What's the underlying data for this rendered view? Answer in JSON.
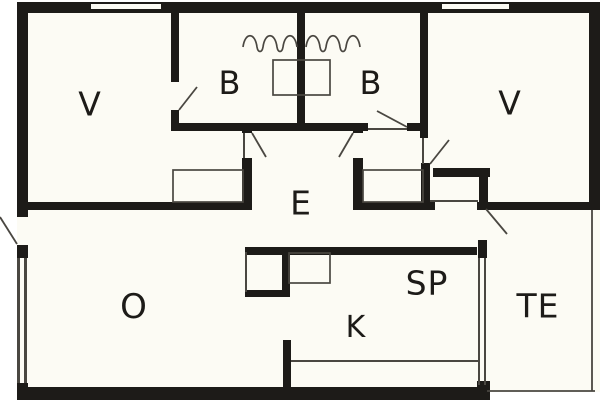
{
  "meta": {
    "title": "House floor plan"
  },
  "colors": {
    "wall": "#1d1b18",
    "floor": "#fcfbf4",
    "thin_line": "#4a4741",
    "label": "#1d1b18",
    "background": "#ffffff"
  },
  "floor": {
    "name": "house-footprint",
    "r": [
      17,
      2,
      583,
      390
    ]
  },
  "rooms": [
    {
      "id": "v1",
      "label": "V",
      "x": 90,
      "y": 104,
      "size": 33
    },
    {
      "id": "b1",
      "label": "B",
      "x": 230,
      "y": 83,
      "size": 32
    },
    {
      "id": "b2",
      "label": "B",
      "x": 371,
      "y": 83,
      "size": 32
    },
    {
      "id": "v2",
      "label": "V",
      "x": 510,
      "y": 103,
      "size": 33
    },
    {
      "id": "e",
      "label": "E",
      "x": 301,
      "y": 203,
      "size": 33
    },
    {
      "id": "o",
      "label": "O",
      "x": 134,
      "y": 307,
      "size": 34
    },
    {
      "id": "sp",
      "label": "SP",
      "x": 427,
      "y": 283,
      "size": 33
    },
    {
      "id": "k",
      "label": "K",
      "x": 356,
      "y": 328,
      "size": 30
    },
    {
      "id": "te",
      "label": "TE",
      "x": 538,
      "y": 306,
      "size": 33
    }
  ],
  "walls": [
    {
      "name": "top-wall",
      "r": [
        17,
        2,
        583,
        11
      ]
    },
    {
      "name": "left-wall-upper",
      "r": [
        17,
        2,
        11,
        215
      ]
    },
    {
      "name": "left-wall-mid-stub",
      "r": [
        17,
        245,
        11,
        13
      ]
    },
    {
      "name": "left-wall-bottom-stub",
      "r": [
        17,
        383,
        11,
        17
      ]
    },
    {
      "name": "bottom-wall",
      "r": [
        17,
        387,
        473,
        13
      ]
    },
    {
      "name": "right-wall",
      "r": [
        589,
        2,
        11,
        208
      ]
    },
    {
      "name": "terrace-top-wall",
      "r": [
        477,
        202,
        123,
        8
      ]
    },
    {
      "name": "v1-b1-wall-upper",
      "r": [
        171,
        13,
        8,
        69
      ]
    },
    {
      "name": "v1-b1-wall-lower",
      "r": [
        171,
        110,
        8,
        21
      ]
    },
    {
      "name": "b1-b2-divider",
      "r": [
        297,
        13,
        8,
        110
      ]
    },
    {
      "name": "b2-v2-wall",
      "r": [
        420,
        13,
        8,
        125
      ]
    },
    {
      "name": "v2-door-side-wall",
      "r": [
        421,
        163,
        9,
        47
      ]
    },
    {
      "name": "hall-north-wall-left",
      "r": [
        171,
        123,
        197,
        8
      ]
    },
    {
      "name": "hall-north-wall-right",
      "r": [
        407,
        123,
        21,
        8
      ]
    },
    {
      "name": "hall-left-wall-stub",
      "r": [
        242,
        123,
        10,
        10
      ]
    },
    {
      "name": "hall-left-wall",
      "r": [
        242,
        158,
        10,
        52
      ]
    },
    {
      "name": "hall-right-wall-stub",
      "r": [
        353,
        123,
        10,
        10
      ]
    },
    {
      "name": "hall-right-wall",
      "r": [
        353,
        158,
        10,
        52
      ]
    },
    {
      "name": "v1-south-wall",
      "r": [
        17,
        202,
        235,
        8
      ]
    },
    {
      "name": "hall-south-wall",
      "r": [
        353,
        202,
        82,
        8
      ]
    },
    {
      "name": "nook-north-wall",
      "r": [
        433,
        168,
        57,
        9
      ]
    },
    {
      "name": "nook-east-wall",
      "r": [
        479,
        177,
        9,
        27
      ]
    },
    {
      "name": "kitchen-north-wall",
      "r": [
        245,
        247,
        232,
        8
      ]
    },
    {
      "name": "kitchen-west-wall",
      "r": [
        283,
        340,
        8,
        47
      ]
    },
    {
      "name": "terrace-door-side-wall",
      "r": [
        478,
        240,
        9,
        18
      ]
    },
    {
      "name": "terrace-window-stub",
      "r": [
        477,
        381,
        13,
        19
      ]
    },
    {
      "name": "cupboard-east-wall",
      "r": [
        282,
        252,
        8,
        45
      ]
    },
    {
      "name": "cupboard-south-wall",
      "r": [
        245,
        290,
        45,
        7
      ]
    }
  ],
  "window_slots": [
    {
      "name": "window-top-left",
      "r": [
        91,
        4,
        70,
        5
      ]
    },
    {
      "name": "window-top-right",
      "r": [
        442,
        4,
        67,
        5
      ]
    }
  ],
  "window_lines": [
    {
      "name": "window-left-outer-line",
      "r": [
        17,
        258,
        3,
        125
      ]
    },
    {
      "name": "window-left-inner-line",
      "r": [
        24,
        258,
        3,
        125
      ]
    },
    {
      "name": "window-terrace-outer-line",
      "r": [
        478,
        258,
        2,
        127
      ]
    },
    {
      "name": "window-terrace-inner-line",
      "r": [
        484,
        258,
        2,
        127
      ]
    }
  ],
  "thin_lines": [
    {
      "name": "kitchen-counter-line",
      "r": [
        291,
        360,
        188,
        2
      ]
    },
    {
      "name": "nook-south-line",
      "r": [
        430,
        200,
        48,
        2
      ]
    },
    {
      "name": "cupboard-west-line",
      "r": [
        245,
        252,
        2,
        40
      ]
    },
    {
      "name": "b2-door-leaf",
      "r": [
        368,
        128,
        39,
        2
      ]
    },
    {
      "name": "hall-left-door-leaf",
      "r": [
        243,
        133,
        2,
        25
      ]
    },
    {
      "name": "v2-door-leaf",
      "r": [
        422,
        138,
        2,
        26
      ]
    }
  ],
  "furniture": [
    {
      "name": "bed-between-b-rooms",
      "r": [
        273,
        60,
        57,
        35
      ]
    },
    {
      "name": "wardrobe-left",
      "r": [
        173,
        170,
        70,
        32
      ]
    },
    {
      "name": "wardrobe-right",
      "r": [
        363,
        170,
        60,
        32
      ]
    },
    {
      "name": "kitchen-box",
      "r": [
        289,
        253,
        41,
        30
      ]
    }
  ],
  "door_swings": [
    {
      "name": "entry-door-swing",
      "l": [
        0,
        217,
        17,
        244
      ]
    },
    {
      "name": "b1-door-swing",
      "l": [
        179,
        110,
        197,
        87
      ]
    },
    {
      "name": "b2-door-swing",
      "l": [
        407,
        127,
        377,
        111
      ]
    },
    {
      "name": "hall-left-door-swing",
      "l": [
        252,
        133,
        266,
        157
      ]
    },
    {
      "name": "hall-right-door-swing",
      "l": [
        353,
        133,
        339,
        157
      ]
    },
    {
      "name": "v2-door-swing",
      "l": [
        430,
        164,
        449,
        140
      ]
    },
    {
      "name": "terrace-door-swing",
      "l": [
        486,
        209,
        507,
        234
      ]
    }
  ],
  "terrace_outline": [
    {
      "name": "terrace-east-line",
      "l": [
        592,
        210,
        592,
        391
      ]
    },
    {
      "name": "terrace-south-line",
      "l": [
        487,
        391,
        595,
        391
      ]
    }
  ],
  "waves": [
    {
      "name": "wave-line-left",
      "d": "M 243 47 c 2 -15 12 -15 14 0 c 1 6 5 6 6 0 c 2 -15 12 -15 14 0 c 1 6 5 6 6 0 c 2 -15 12 -15 14 0"
    },
    {
      "name": "wave-line-right",
      "d": "M 306 47 c 2 -15 12 -15 14 0 c 1 6 5 6 6 0 c 2 -15 12 -15 14 0 c 1 6 5 6 6 0 c 2 -15 12 -15 14 0"
    }
  ]
}
